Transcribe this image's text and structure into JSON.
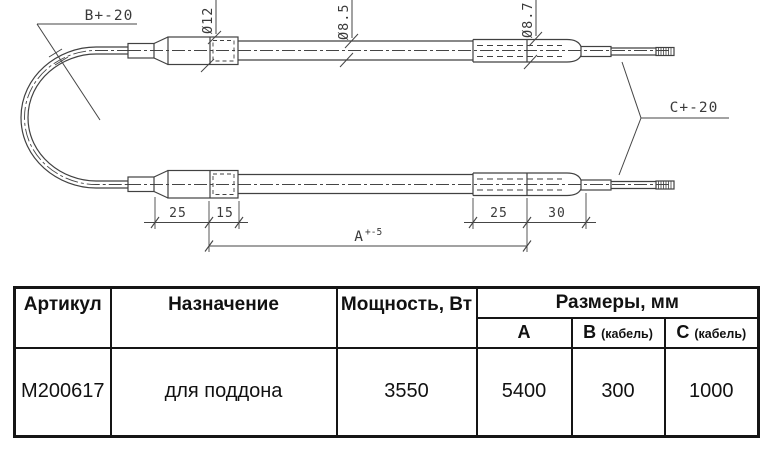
{
  "drawing": {
    "dim_b": "B+-20",
    "dim_c": "C+-20",
    "dim_a": "A",
    "dim_a_tol": "+-5",
    "dia_nut": "Ø12",
    "dia_tube": "Ø8.5",
    "dia_fitting": "Ø8.7",
    "len_left_1": "25",
    "len_left_2": "15",
    "len_right_1": "25",
    "len_right_2": "30"
  },
  "table": {
    "col_article": "Артикул",
    "col_purpose": "Назначение",
    "col_power": "Мощность, Вт",
    "col_dimensions": "Размеры, мм",
    "col_a": "A",
    "col_b": "B",
    "col_b_note": "(кабель)",
    "col_c": "C",
    "col_c_note": "(кабель)",
    "row": {
      "article": "M200617",
      "purpose": "для поддона",
      "power": "3550",
      "a": "5400",
      "b": "300",
      "c": "1000"
    }
  }
}
